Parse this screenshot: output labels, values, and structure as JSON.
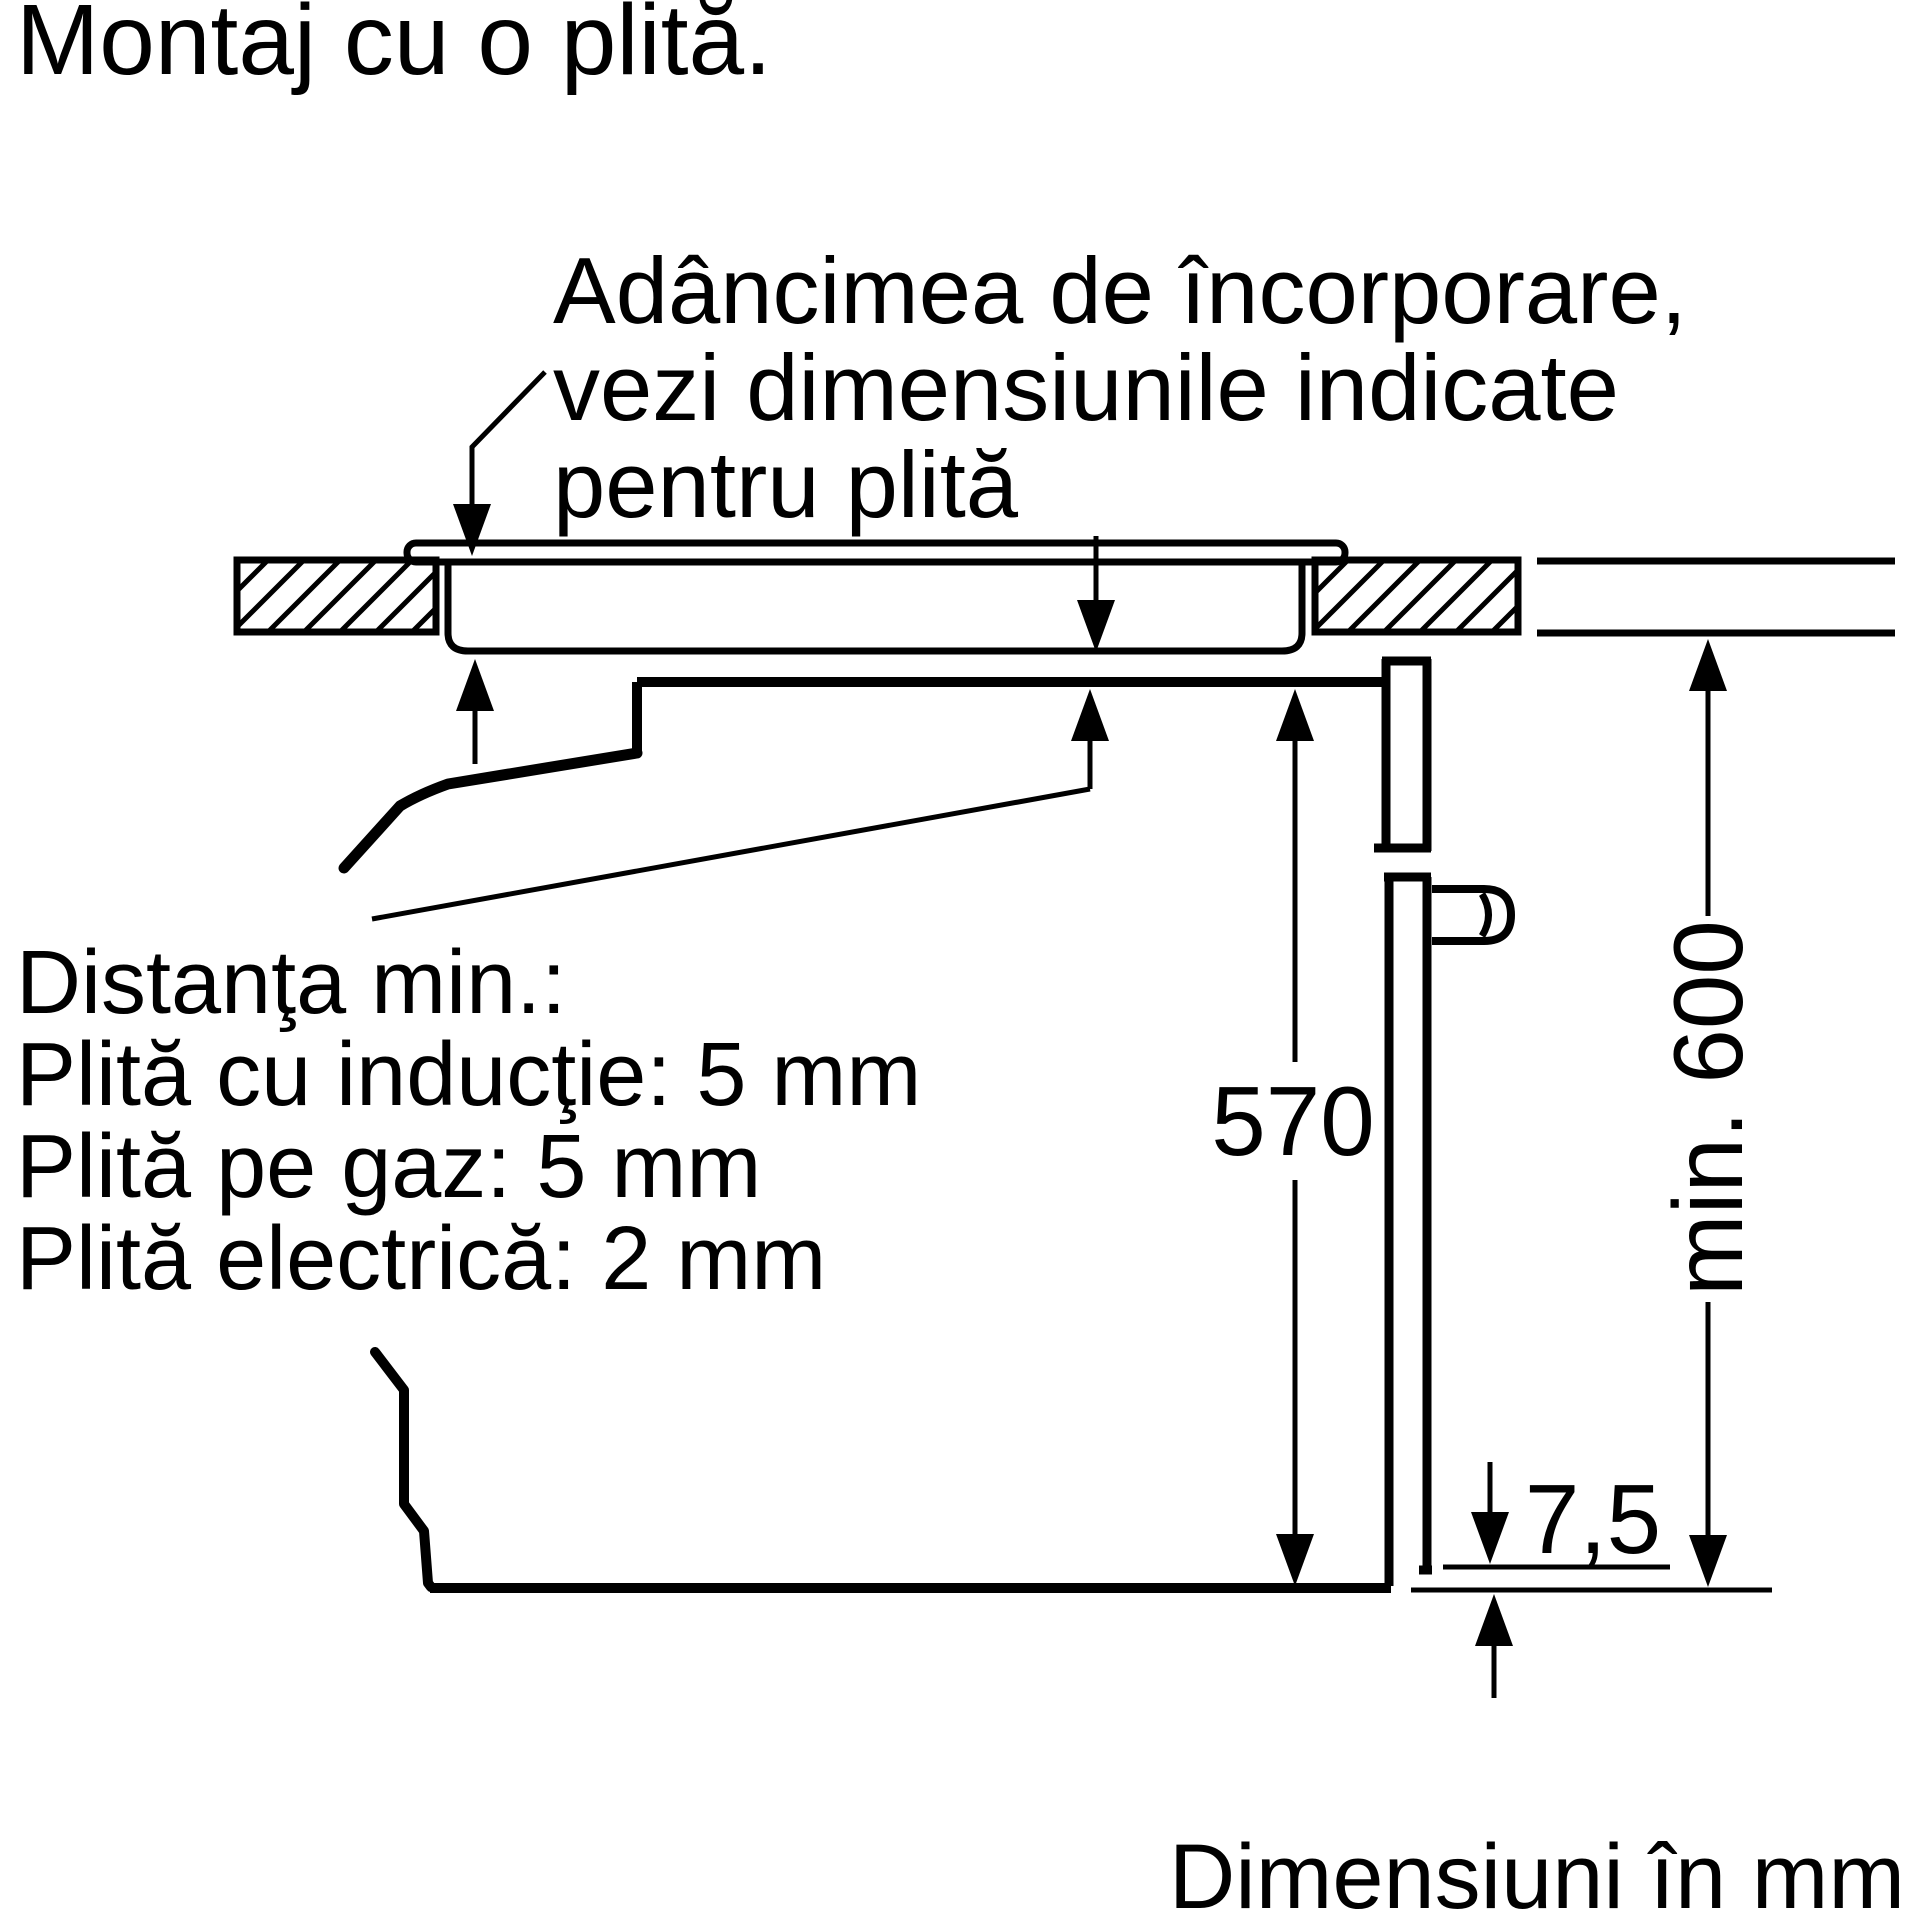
{
  "colors": {
    "ink": "#000000",
    "paper": "#ffffff"
  },
  "title": "Montaj cu o plită.",
  "note_embedding_depth": {
    "line1": "Adâncimea de încorporare,",
    "line2": "vezi dimensiunile indicate",
    "line3": "pentru plită"
  },
  "note_min_distance": {
    "line1": "Distanţa min.:",
    "line2": "Plită cu inducţie: 5 mm",
    "line3": "Plită pe gaz: 5 mm",
    "line4": "Plită electrică: 2 mm"
  },
  "dimensions": {
    "oven_height_mm": "570",
    "niche_height_mm": "min. 600",
    "front_gap_mm": "7,5"
  },
  "footer": "Dimensiuni în mm"
}
